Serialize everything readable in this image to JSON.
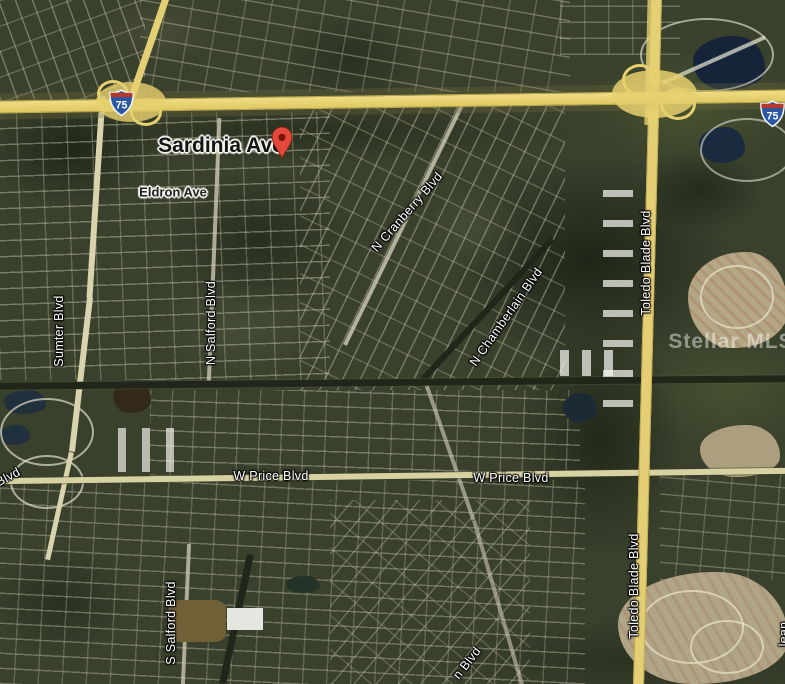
{
  "map": {
    "shield_route": "75",
    "watermark": "Stellar MLS",
    "labels": {
      "sardinia_ave": "Sardinia Ave",
      "eldron_ave": "Eldron Ave",
      "sumter_blvd": "Sumter Blvd",
      "n_salford_blvd": "N Salford Blvd",
      "n_cranberry_blvd": "N Cranberry Blvd",
      "n_chamberlain_blvd": "N Chamberlain Blvd",
      "toledo_blade_blvd_upper": "Toledo Blade Blvd",
      "toledo_blade_blvd_lower": "Toledo Blade Blvd",
      "w_price_blvd_west": "W Price Blvd",
      "w_price_blvd_east": "W Price Blvd",
      "s_salford_blvd": "S Salford Blvd",
      "partial_blvd_left_edge": "Blvd",
      "partial_blvd_bottom": "n Blvd",
      "partial_right_edge": "lean"
    },
    "colors": {
      "highway_yellow": "#e5cf74",
      "minor_road": "#d4cfb8",
      "water": "#182a3e",
      "pin_red": "#e2493b",
      "terrain_green": "#39402c"
    }
  }
}
